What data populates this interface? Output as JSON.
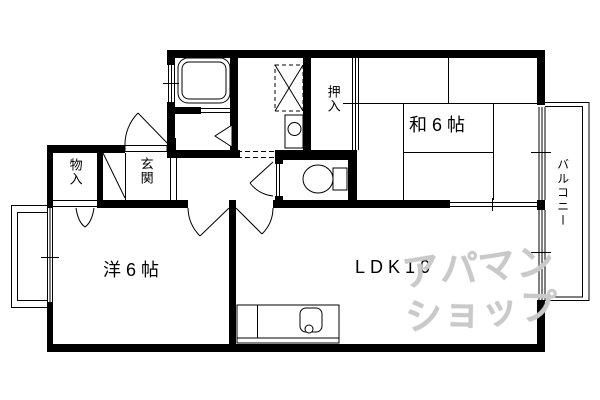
{
  "floorplan": {
    "labels": {
      "monoire": "物入",
      "genkan": "玄関",
      "oshiire": "押入",
      "washitsu": "和6帖",
      "western": "洋6帖",
      "ldk": "LDK10",
      "balcony": "バルコニー"
    },
    "watermark": {
      "line1": "アパマン",
      "line2": "ショップ"
    },
    "colors": {
      "line": "#000000",
      "background": "#ffffff",
      "watermark": "#c9c9c9"
    },
    "icons": {
      "bathtub": "bathtub-icon",
      "washing_machine": "washing-machine-icon",
      "washbasin": "washbasin-icon",
      "toilet": "toilet-icon",
      "kitchen_sink": "kitchen-sink-icon"
    }
  }
}
